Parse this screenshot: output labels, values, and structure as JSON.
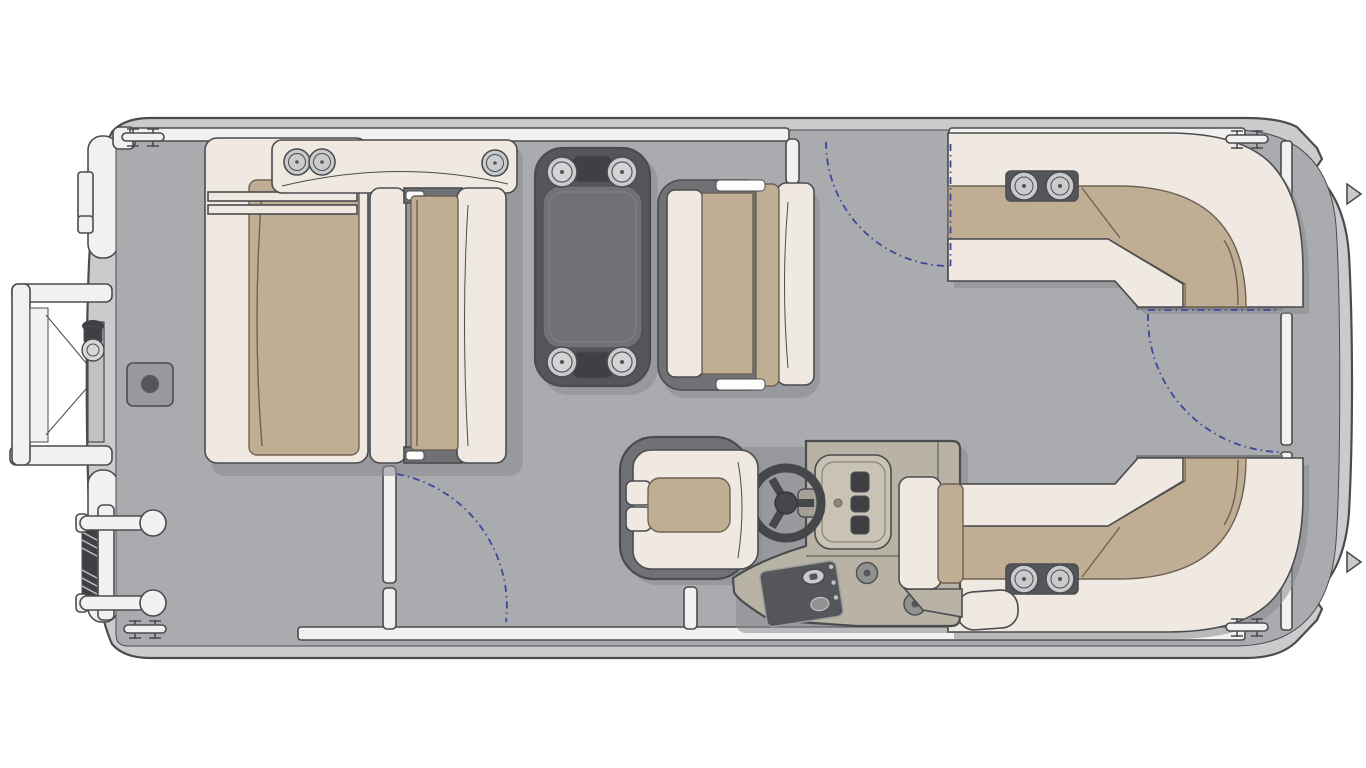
{
  "diagram": {
    "title": "Pontoon boat floor plan — overhead view",
    "type": "floorplan"
  },
  "components": {
    "hull": "Pontoon hull and outer deck rim",
    "deck": "Main deck",
    "bow_boarding_gate": "Bow boarding gate with gangway ramp (open)",
    "boarding_ladder": "Stowed boarding ladder",
    "bow_light": "Bow navigation light",
    "cleat": "Mooring cleat",
    "table_base_mount": "Table base deck mount",
    "bow_lounge": "Bow L-lounge with cup-holder armrest",
    "bow_facing_bench": "Facing bench seat",
    "dinette_table": "Table with four cup holders",
    "dinette_bench": "Dinette bench seat",
    "port_side_gate": "Port side gate shown open",
    "port_gate_post": "Side gate latch post",
    "starboard_bow_gate": "Starboard bow gate opening",
    "gate_swing": "Gate swing path",
    "captains_chair": "Captain's chair",
    "helm_console": "Helm console",
    "steering_wheel": "Steering wheel",
    "helm_dash": "Instrument panel",
    "switch_panel": "Ignition / switch panel",
    "speaker": "Speaker",
    "helm_side_seat": "Helm-side jump seat",
    "stern_lounge_starboard": "Starboard stern wraparound lounge",
    "stern_lounge_port": "Port stern wraparound lounge",
    "cup_holder": "Cup holder",
    "stern_walkway": "Stern walkway",
    "stern_gate": "Stern gate",
    "stern_pod": "Corner step pod",
    "fence_rail": "Fence rail",
    "fin": "Pontoon fin"
  },
  "colors": {
    "outline": "#4a4c4f",
    "hull": "#c9cbcd",
    "hullline": "#54565a",
    "deck": "#a9abae",
    "edge": "#797b7f",
    "rail": "#f1f1ef",
    "cream": "#efe9e1",
    "tan": "#bfae93",
    "tanline": "#6e6253",
    "dark": "#54565a",
    "darkmid": "#6f7174",
    "ring": "#c9cbcd",
    "consoletan": "#b9b3a5",
    "consolelight": "#c9c3b5",
    "consoleline": "#8a8478",
    "gauge": "#3e4043",
    "mount": "#97999c",
    "shadow": "#898b8e",
    "blue": "#44449b"
  }
}
